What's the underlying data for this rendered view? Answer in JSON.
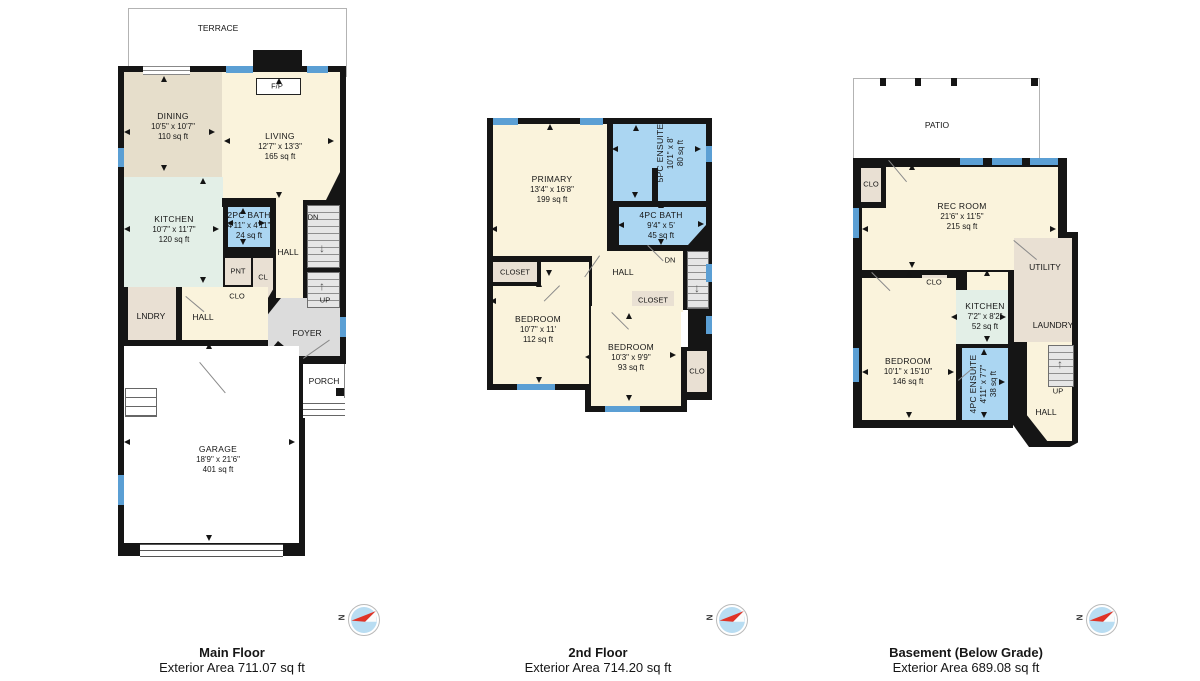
{
  "colors": {
    "wall": "#151515",
    "cream": "#FAF3DC",
    "tan": "#E6DECB",
    "mint": "#E3EFE7",
    "bath_blue": "#ABD6F2",
    "window_blue": "#5B9FD4",
    "closet_tan": "#E9E0D3",
    "foyer_gray": "#DCDCDC",
    "stair_gray": "#E6E6E6",
    "compass_blue": "#B9DDF2",
    "needle_red": "#E03326"
  },
  "compass": {
    "north": "N"
  },
  "icons": {
    "stairs_down_arrow": "↓",
    "stairs_up_arrow": "↑"
  },
  "captions": {
    "main": {
      "title": "Main Floor",
      "subtitle": "Exterior Area 711.07 sq ft"
    },
    "second": {
      "title": "2nd Floor",
      "subtitle": "Exterior Area 714.20 sq ft"
    },
    "basement": {
      "title": "Basement (Below Grade)",
      "subtitle": "Exterior Area 689.08 sq ft"
    }
  },
  "main": {
    "terrace": "TERRACE",
    "fp": "F/P",
    "porch": "PORCH",
    "dining": {
      "name": "DINING",
      "dims": "10'5\" x 10'7\"",
      "area": "110 sq ft"
    },
    "living": {
      "name": "LIVING",
      "dims": "12'7\" x 13'3\"",
      "area": "165 sq ft"
    },
    "kitchen": {
      "name": "KITCHEN",
      "dims": "10'7\" x 11'7\"",
      "area": "120 sq ft"
    },
    "bath": {
      "name": "2PC BATH",
      "dims": "4'11\" x 4'11\"",
      "area": "24 sq ft"
    },
    "garage": {
      "name": "GARAGE",
      "dims": "18'9\" x 21'6\"",
      "area": "401 sq ft"
    },
    "hall_upper": "HALL",
    "hall_lower": "HALL",
    "pnt": "PNT",
    "cl": "CL",
    "clo": "CLO",
    "lndry": "LNDRY",
    "foyer": "FOYER",
    "dn": "DN",
    "up": "UP"
  },
  "second": {
    "primary": {
      "name": "PRIMARY",
      "dims": "13'4\" x 16'8\"",
      "area": "199 sq ft"
    },
    "ensuite": {
      "name": "5PC ENSUITE",
      "dims": "10'1\" x 8'",
      "area": "80 sq ft"
    },
    "bath": {
      "name": "4PC BATH",
      "dims": "9'4\" x 5'",
      "area": "45 sq ft"
    },
    "bedroom1": {
      "name": "BEDROOM",
      "dims": "10'7\" x 11'",
      "area": "112 sq ft"
    },
    "bedroom2": {
      "name": "BEDROOM",
      "dims": "10'3\" x 9'9\"",
      "area": "93 sq ft"
    },
    "closet1": "CLOSET",
    "closet2": "CLOSET",
    "hall": "HALL",
    "clo": "CLO",
    "dn": "DN"
  },
  "basement": {
    "patio": "PATIO",
    "rec": {
      "name": "REC ROOM",
      "dims": "21'6\" x 11'5\"",
      "area": "215 sq ft"
    },
    "kitchen": {
      "name": "KITCHEN",
      "dims": "7'2\" x 8'2\"",
      "area": "52 sq ft"
    },
    "bedroom": {
      "name": "BEDROOM",
      "dims": "10'1\" x 15'10\"",
      "area": "146 sq ft"
    },
    "ensuite": {
      "name": "4PC ENSUITE",
      "dims": "4'11\" x 7'7\"",
      "area": "38 sq ft"
    },
    "clo1": "CLO",
    "clo2": "CLO",
    "utility": "UTILITY",
    "laundry": "LAUNDRY",
    "hall": "HALL",
    "up": "UP"
  }
}
